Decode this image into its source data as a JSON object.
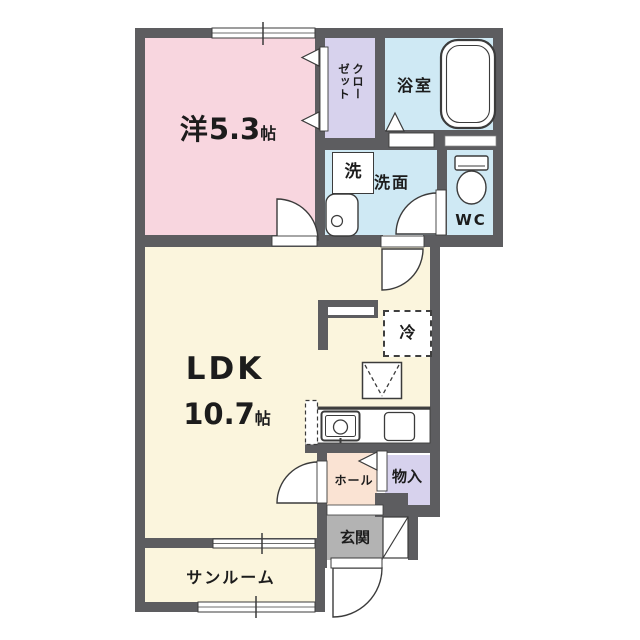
{
  "title": "apartment-floor-plan",
  "rooms": {
    "western": {
      "name": "洋",
      "area": "5.3",
      "unit": "帖"
    },
    "ldk": {
      "name": "LDK",
      "area": "10.7",
      "unit": "帖"
    },
    "closet": {
      "name": "クローゼット"
    },
    "bathroom": {
      "name": "浴室"
    },
    "washer": {
      "name": "洗"
    },
    "washroom": {
      "name": "洗面"
    },
    "toilet_room": {
      "name": "WC"
    },
    "refrigerator": {
      "name": "冷"
    },
    "hall": {
      "name": "ホール"
    },
    "storage": {
      "name": "物入"
    },
    "entrance": {
      "name": "玄関"
    },
    "sunroom": {
      "name": "サンルーム"
    }
  },
  "colors": {
    "wall": "#5d5d60",
    "western_room": "#f8d6df",
    "closet": "#d7d2ed",
    "wet_area": "#cfe9f4",
    "ldk": "#fbf5dd",
    "hall": "#fae3d3",
    "storage": "#d7d2ed",
    "entrance": "#b3b3b3",
    "outline": "#3b3b3b"
  }
}
